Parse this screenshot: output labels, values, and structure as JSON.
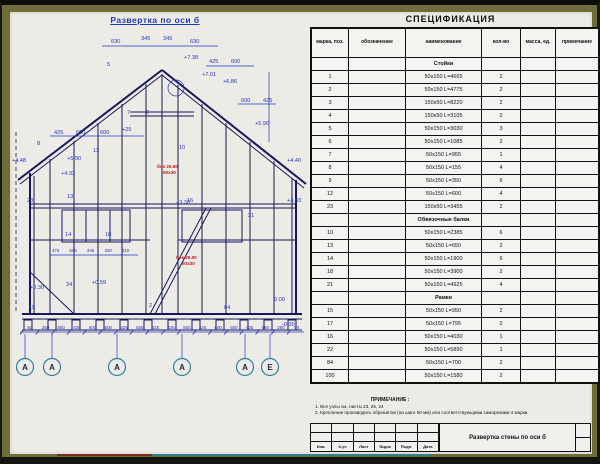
{
  "colors": {
    "accent_blue": "#2037c0",
    "line_navy": "#17175e",
    "red_note": "#c01616",
    "paper": "#edebe6",
    "frame_olive": "#6e6d38"
  },
  "drawing": {
    "title": "Развертка по оси б",
    "labels": [
      {
        "t": "630",
        "x": 101,
        "y": 31
      },
      {
        "t": "345",
        "x": 131,
        "y": 28
      },
      {
        "t": "345",
        "x": 153,
        "y": 28
      },
      {
        "t": "630",
        "x": 180,
        "y": 31
      },
      {
        "t": "5",
        "x": 97,
        "y": 54
      },
      {
        "t": "+7.38",
        "x": 174,
        "y": 47
      },
      {
        "t": "425",
        "x": 199,
        "y": 51
      },
      {
        "t": "600",
        "x": 221,
        "y": 51
      },
      {
        "t": "+7.01",
        "x": 192,
        "y": 64
      },
      {
        "t": "+6.86",
        "x": 213,
        "y": 71
      },
      {
        "t": "600",
        "x": 231,
        "y": 90
      },
      {
        "t": "425",
        "x": 253,
        "y": 90
      },
      {
        "t": "+5.90",
        "x": 245,
        "y": 113
      },
      {
        "t": "425",
        "x": 44,
        "y": 122
      },
      {
        "t": "600",
        "x": 66,
        "y": 122
      },
      {
        "t": "600",
        "x": 90,
        "y": 122
      },
      {
        "t": "+25",
        "x": 112,
        "y": 119
      },
      {
        "t": "+5.90",
        "x": 57,
        "y": 148
      },
      {
        "t": "7",
        "x": 117,
        "y": 102
      },
      {
        "t": "2",
        "x": 136,
        "y": 102
      },
      {
        "t": "8",
        "x": 27,
        "y": 133
      },
      {
        "t": "12",
        "x": 83,
        "y": 140
      },
      {
        "t": "10",
        "x": 169,
        "y": 137
      },
      {
        "t": "+4.48",
        "x": 2,
        "y": 150
      },
      {
        "t": "+4.32",
        "x": 51,
        "y": 163
      },
      {
        "t": "+4.40",
        "x": 277,
        "y": 150
      },
      {
        "t": "+3.83",
        "x": 277,
        "y": 190
      },
      {
        "t": "+3.30",
        "x": 166,
        "y": 192
      },
      {
        "t": "23",
        "x": 17,
        "y": 190
      },
      {
        "t": "13",
        "x": 57,
        "y": 186
      },
      {
        "t": "18",
        "x": 95,
        "y": 224
      },
      {
        "t": "14",
        "x": 55,
        "y": 224
      },
      {
        "t": "16",
        "x": 177,
        "y": 190
      },
      {
        "t": "21",
        "x": 238,
        "y": 205
      },
      {
        "t": "15",
        "x": 19,
        "y": 297
      },
      {
        "t": "34",
        "x": 56,
        "y": 274
      },
      {
        "t": "2",
        "x": 139,
        "y": 295
      },
      {
        "t": "84",
        "x": 214,
        "y": 297
      },
      {
        "t": "+0.59",
        "x": 82,
        "y": 272
      },
      {
        "t": "+0.30",
        "x": 20,
        "y": 277
      },
      {
        "t": "0.00",
        "x": 264,
        "y": 289
      },
      {
        "t": "-0.30",
        "x": 272,
        "y": 314
      }
    ],
    "red_labels": [
      {
        "t": "бок 25.60",
        "x": 147,
        "y": 156
      },
      {
        "t": "50х30",
        "x": 153,
        "y": 162
      },
      {
        "t": "бок 25.00",
        "x": 166,
        "y": 247
      },
      {
        "t": "50х30",
        "x": 172,
        "y": 253
      }
    ],
    "mid_dims": [
      "475",
      "590",
      "345",
      "320",
      "310"
    ],
    "bottom_dims": [
      "50",
      "250",
      "550",
      "425",
      "600",
      "600",
      "425",
      "550",
      "425",
      "425",
      "550",
      "425",
      "600",
      "600",
      "425",
      "550",
      "250",
      "50"
    ],
    "axes": [
      {
        "l": "А",
        "x": 15
      },
      {
        "l": "А",
        "x": 42
      },
      {
        "l": "А",
        "x": 107
      },
      {
        "l": "А",
        "x": 172
      },
      {
        "l": "А",
        "x": 235
      },
      {
        "l": "Е",
        "x": 260
      }
    ]
  },
  "spec": {
    "title": "СПЕЦИФИКАЦИЯ",
    "headers": [
      "марка, поз.",
      "обозначение",
      "наименование",
      "кол-во",
      "масса, ед.",
      "примечание"
    ],
    "rows": [
      {
        "section": "Стойки"
      },
      {
        "pos": "1",
        "name": "50х150 L=4665",
        "qty": "2"
      },
      {
        "pos": "2",
        "name": "50х150 L=4775",
        "qty": "2"
      },
      {
        "pos": "3",
        "name": "150х50 L=8220",
        "qty": "2"
      },
      {
        "pos": "4",
        "name": "150х50 L=3105",
        "qty": "2"
      },
      {
        "pos": "5",
        "name": "50х150 L=3030",
        "qty": "3"
      },
      {
        "pos": "6",
        "name": "50х150 L=1085",
        "qty": "2"
      },
      {
        "pos": "7",
        "name": "50х150 L=955",
        "qty": "1"
      },
      {
        "pos": "8",
        "name": "50х150 L=155",
        "qty": "4"
      },
      {
        "pos": "9",
        "name": "50х150 L=350",
        "qty": "6"
      },
      {
        "pos": "12",
        "name": "50х150 L=600",
        "qty": "4"
      },
      {
        "pos": "23",
        "name": "150х50 L=3455",
        "qty": "2"
      },
      {
        "section": "Обвязочные балки"
      },
      {
        "pos": "10",
        "name": "50х150 L=2385",
        "qty": "6"
      },
      {
        "pos": "13",
        "name": "50х150 L=650",
        "qty": "2"
      },
      {
        "pos": "14",
        "name": "50х150 L=1900",
        "qty": "6"
      },
      {
        "pos": "18",
        "name": "50х150 L=3900",
        "qty": "2"
      },
      {
        "pos": "21",
        "name": "50х150 L=4925",
        "qty": "4"
      },
      {
        "section": "Рамки"
      },
      {
        "pos": "15",
        "name": "50х150 L=950",
        "qty": "2"
      },
      {
        "pos": "17",
        "name": "50х150 L=795",
        "qty": "2"
      },
      {
        "pos": "16",
        "name": "50х150 L=4030",
        "qty": "1"
      },
      {
        "pos": "22",
        "name": "50х150 L=5890",
        "qty": "1"
      },
      {
        "pos": "84",
        "name": "50х150 L=700",
        "qty": "2"
      },
      {
        "pos": "100",
        "name": "50х150 L=1580",
        "qty": "2"
      }
    ]
  },
  "notes": {
    "heading": "ПРИМЕЧАНИЕ :",
    "items": [
      "1.  Все узлы см. листы 23, 25, 24",
      "2.  Крепление производить обрешётки (на шаге 50 мм) или соответствующими саморезами 4 марки."
    ]
  },
  "titleblock": {
    "doc_title": "Развертка стены по оси б",
    "cells": [
      "Изм.",
      "К.уч",
      "Лист",
      "№док",
      "Подп.",
      "Дата"
    ]
  }
}
